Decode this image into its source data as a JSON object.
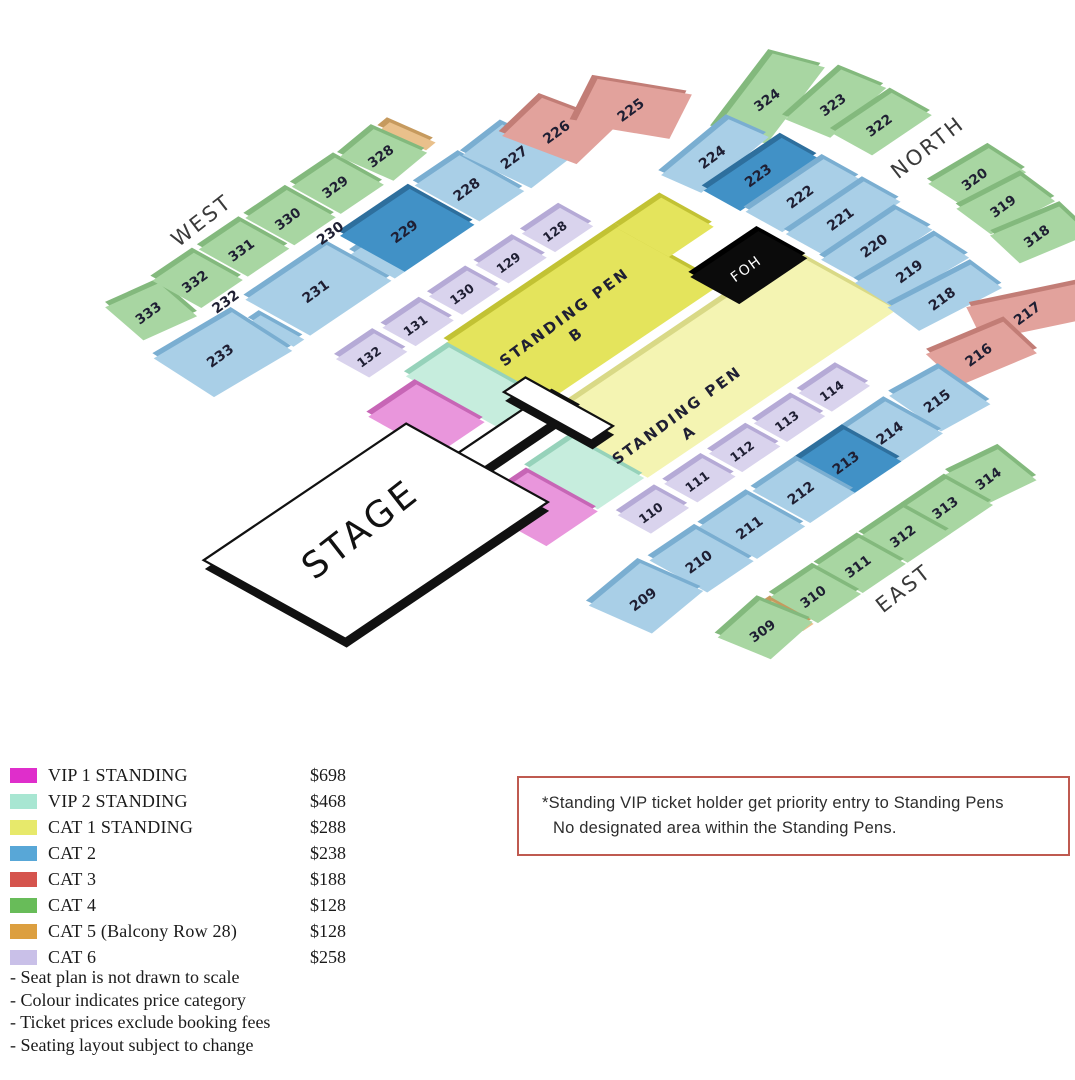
{
  "map": {
    "stage_label": "STAGE",
    "foh_label": "FOH",
    "pen_b_lines": [
      "STANDING PEN",
      "B"
    ],
    "pen_a_lines": [
      "STANDING PEN",
      "A"
    ],
    "direction_labels": {
      "west": "WEST",
      "north": "NORTH",
      "east": "EAST"
    },
    "sections": [
      {
        "id": "333",
        "category": "cat4"
      },
      {
        "id": "332",
        "category": "cat4"
      },
      {
        "id": "331",
        "category": "cat4"
      },
      {
        "id": "330",
        "category": "cat4"
      },
      {
        "id": "329",
        "category": "cat4"
      },
      {
        "id": "328",
        "category": "cat4"
      },
      {
        "id": "324",
        "category": "cat4"
      },
      {
        "id": "323",
        "category": "cat4"
      },
      {
        "id": "322",
        "category": "cat4"
      },
      {
        "id": "320",
        "category": "cat4"
      },
      {
        "id": "319",
        "category": "cat4"
      },
      {
        "id": "318",
        "category": "cat4"
      },
      {
        "id": "314",
        "category": "cat4"
      },
      {
        "id": "313",
        "category": "cat4"
      },
      {
        "id": "312",
        "category": "cat4"
      },
      {
        "id": "311",
        "category": "cat4"
      },
      {
        "id": "310",
        "category": "cat4"
      },
      {
        "id": "309",
        "category": "cat4"
      },
      {
        "id": "233",
        "category": "cat2"
      },
      {
        "id": "232",
        "category": "cat2",
        "label_only": true
      },
      {
        "id": "231",
        "category": "cat2"
      },
      {
        "id": "230",
        "category": "cat2",
        "label_only": true
      },
      {
        "id": "229",
        "category": "cat2",
        "shade": "dark"
      },
      {
        "id": "228",
        "category": "cat2"
      },
      {
        "id": "227",
        "category": "cat2"
      },
      {
        "id": "226",
        "category": "cat3"
      },
      {
        "id": "225",
        "category": "cat3"
      },
      {
        "id": "224",
        "category": "cat2"
      },
      {
        "id": "223",
        "category": "cat2",
        "shade": "dark"
      },
      {
        "id": "222",
        "category": "cat2"
      },
      {
        "id": "221",
        "category": "cat2"
      },
      {
        "id": "220",
        "category": "cat2"
      },
      {
        "id": "219",
        "category": "cat2"
      },
      {
        "id": "218",
        "category": "cat2"
      },
      {
        "id": "217",
        "category": "cat3"
      },
      {
        "id": "216",
        "category": "cat3"
      },
      {
        "id": "215",
        "category": "cat2"
      },
      {
        "id": "214",
        "category": "cat2"
      },
      {
        "id": "213",
        "category": "cat2",
        "shade": "dark"
      },
      {
        "id": "212",
        "category": "cat2"
      },
      {
        "id": "211",
        "category": "cat2"
      },
      {
        "id": "210",
        "category": "cat2"
      },
      {
        "id": "209",
        "category": "cat2"
      },
      {
        "id": "132",
        "category": "cat6"
      },
      {
        "id": "131",
        "category": "cat6"
      },
      {
        "id": "130",
        "category": "cat6"
      },
      {
        "id": "129",
        "category": "cat6"
      },
      {
        "id": "128",
        "category": "cat6"
      },
      {
        "id": "110",
        "category": "cat6"
      },
      {
        "id": "111",
        "category": "cat6"
      },
      {
        "id": "112",
        "category": "cat6"
      },
      {
        "id": "113",
        "category": "cat6"
      },
      {
        "id": "114",
        "category": "cat6"
      }
    ]
  },
  "legend": {
    "items": [
      {
        "label": "VIP 1 STANDING",
        "price": "$698",
        "color": "#df2ecb"
      },
      {
        "label": "VIP 2 STANDING",
        "price": "$468",
        "color": "#a8e6d2"
      },
      {
        "label": "CAT 1 STANDING",
        "price": "$288",
        "color": "#e7e96b"
      },
      {
        "label": "CAT 2",
        "price": "$238",
        "color": "#58a7d7"
      },
      {
        "label": "CAT 3",
        "price": "$188",
        "color": "#d5544d"
      },
      {
        "label": "CAT 4",
        "price": "$128",
        "color": "#68bc59"
      },
      {
        "label": "CAT 5 (Balcony Row 28)",
        "price": "$128",
        "color": "#dc9f40"
      },
      {
        "label": "CAT 6",
        "price": "$258",
        "color": "#c9c0e8"
      }
    ]
  },
  "notes": [
    "- Seat plan is not drawn to scale",
    "- Colour indicates price category",
    "- Ticket prices exclude booking fees",
    "- Seating layout subject to change"
  ],
  "notice": {
    "line1": "*Standing VIP ticket holder get priority entry to Standing Pens",
    "line2": "No designated area within the Standing Pens.",
    "border_color": "#bf5a50"
  },
  "palette": {
    "map_fills": {
      "cat2": "#a9cfe7",
      "cat2_dark": "#4191c6",
      "cat3": "#e2a29c",
      "cat4": "#a8d6a2",
      "cat5": "#e9c08b",
      "cat6": "#d9d3ed",
      "cat1_bright": "#e4e45c",
      "cat1_pale": "#f4f4b2",
      "vip1": "#e996dc",
      "vip2": "#c6eddd",
      "foh": "#0b0b0b",
      "stage": "#ffffff"
    }
  }
}
